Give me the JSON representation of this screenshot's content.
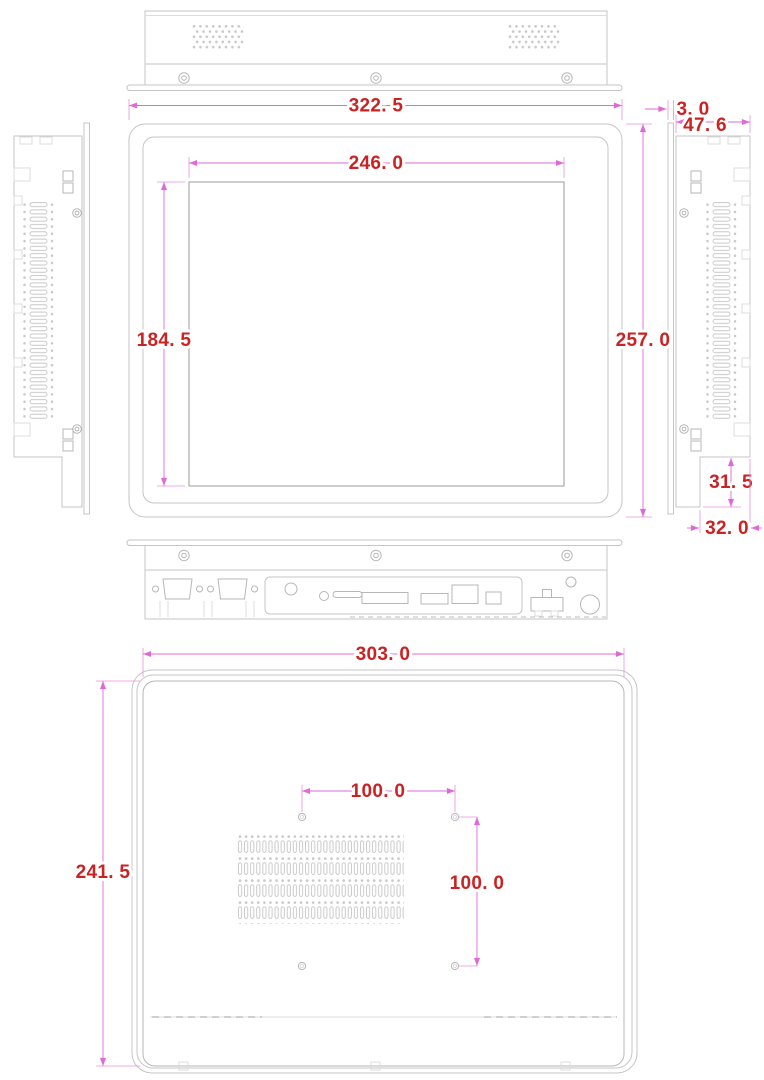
{
  "drawing": {
    "dimensions": {
      "front_view": {
        "overall_width": "322. 5",
        "display_width": "246. 0",
        "display_height": "184. 5",
        "overall_height": "257. 0"
      },
      "side_view": {
        "bezel_thickness": "3. 0",
        "depth": "47. 6",
        "step_height": "31. 5",
        "step_depth": "32. 0"
      },
      "rear_view": {
        "width": "303. 0",
        "height": "241. 5",
        "vesa_horizontal": "100. 0",
        "vesa_vertical": "100. 0"
      }
    },
    "colors": {
      "dimension_text": "#cb2323",
      "dimension_line": "#de6ad8",
      "outline": "#c5c5c5",
      "background": "#ffffff"
    }
  }
}
